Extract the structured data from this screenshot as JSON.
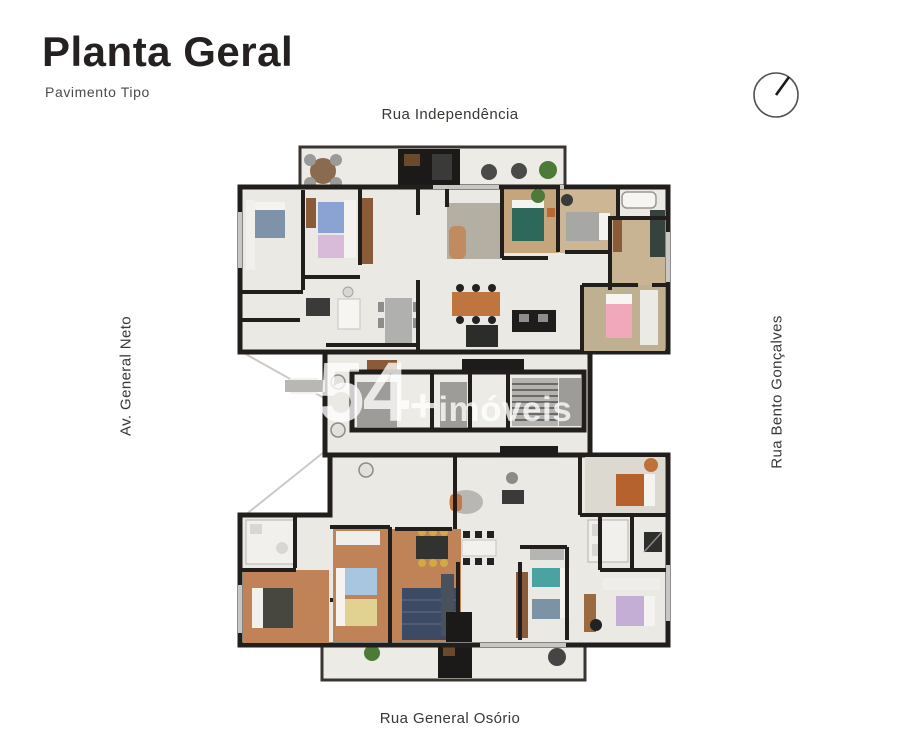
{
  "header": {
    "title": "Planta Geral",
    "subtitle": "Pavimento Tipo"
  },
  "streets": {
    "top": "Rua Independência",
    "left": "Av. General Neto",
    "right": "Rua Bento Gonçalves",
    "bottom": "Rua General Osório"
  },
  "watermark": {
    "number": "54",
    "plus": "+",
    "text": "imóveis"
  },
  "icons": {
    "compass": "north-arrow-compass"
  },
  "colors": {
    "background": "#ffffff",
    "walls": "#211e1c",
    "floor_cream": "#ebe9e3",
    "floor_wood": "#c6a87f",
    "floor_terracotta": "#c08357",
    "text_dark": "#242120",
    "text_gray": "#4e4a47",
    "watermark": "rgba(255,255,255,0.78)",
    "plants": "#4c7a38",
    "navy_rug": "#3c4a64"
  }
}
